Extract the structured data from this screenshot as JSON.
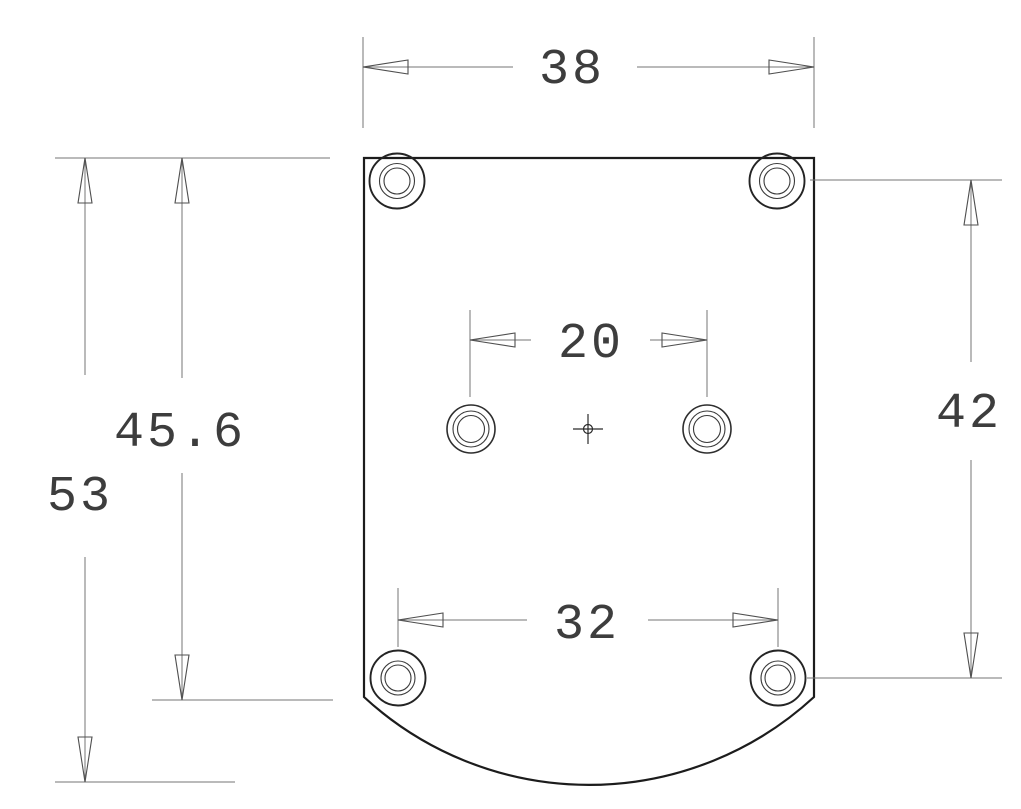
{
  "drawing": {
    "kind": "technical-dimension-drawing",
    "background_color": "#ffffff",
    "outline_color": "#1c1c1c",
    "dimension_line_color": "#757575",
    "text_color": "#3d3d3d",
    "dimensions": {
      "overall_width": {
        "value": "38",
        "orientation": "horizontal"
      },
      "center_hole_spacing": {
        "value": "20",
        "orientation": "horizontal"
      },
      "lower_hole_spacing": {
        "value": "32",
        "orientation": "horizontal"
      },
      "hole_row_spacing": {
        "value": "42",
        "orientation": "vertical"
      },
      "side_height": {
        "value": "45.6",
        "orientation": "vertical"
      },
      "overall_height": {
        "value": "53",
        "orientation": "vertical"
      }
    }
  }
}
